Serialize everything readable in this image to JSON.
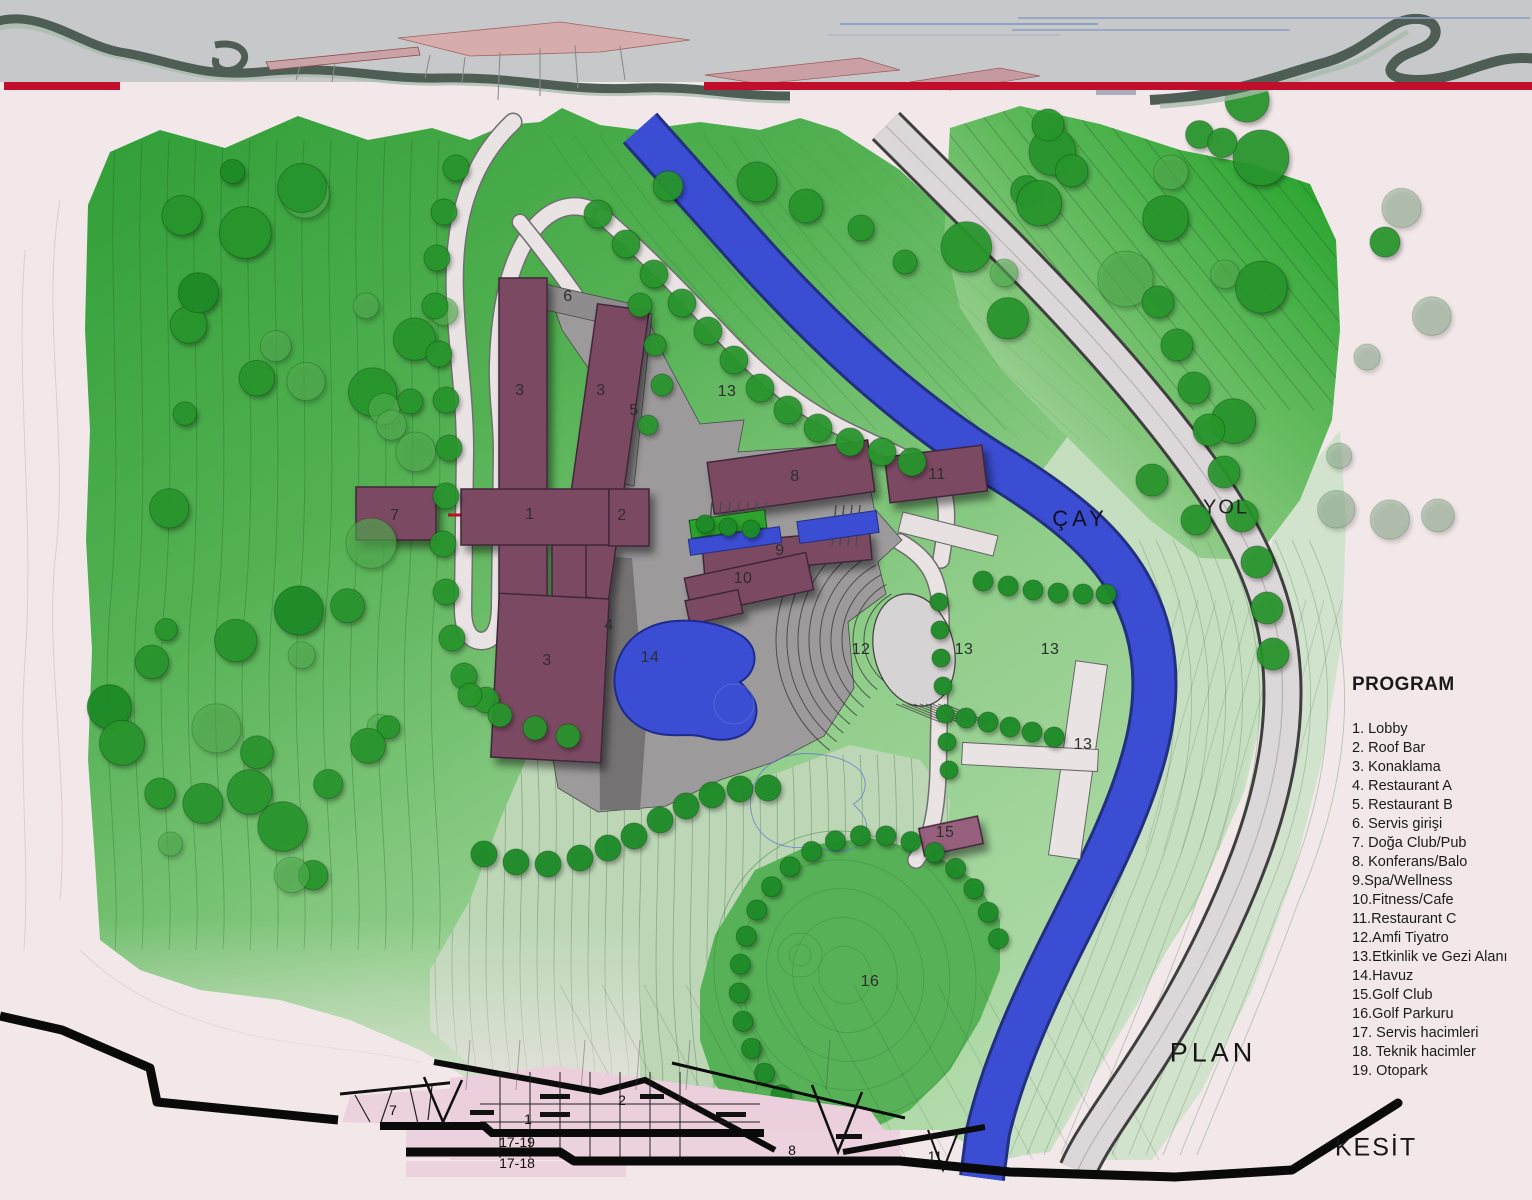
{
  "legend": {
    "title": "PROGRAM",
    "items": [
      "1. Lobby",
      "2. Roof Bar",
      "3. Konaklama",
      "4. Restaurant A",
      "5. Restaurant B",
      "6. Servis girişi",
      "7. Doğa Club/Pub",
      "8. Konferans/Balo",
      "9.Spa/Wellness",
      "10.Fitness/Cafe",
      "11.Restaurant C",
      "12.Amfi Tiyatro",
      "13.Etkinlik ve Gezi Alanı",
      "14.Havuz",
      "15.Golf Club",
      "16.Golf Parkuru",
      "17. Servis hacimleri",
      "18. Teknik hacimler",
      "19. Otopark"
    ]
  },
  "map_labels": {
    "stream": "ÇAY",
    "road": "YOL",
    "plan": "PLAN",
    "section": "KESİT"
  },
  "plan_labels": [
    {
      "text": "6",
      "x": 568,
      "y": 297
    },
    {
      "text": "3",
      "x": 520,
      "y": 391
    },
    {
      "text": "3",
      "x": 601,
      "y": 391
    },
    {
      "text": "5",
      "x": 634,
      "y": 411
    },
    {
      "text": "13",
      "x": 727,
      "y": 392
    },
    {
      "text": "8",
      "x": 795,
      "y": 477
    },
    {
      "text": "11",
      "x": 937,
      "y": 475
    },
    {
      "text": "7",
      "x": 395,
      "y": 516
    },
    {
      "text": "1",
      "x": 530,
      "y": 515
    },
    {
      "text": "2",
      "x": 622,
      "y": 516
    },
    {
      "text": "9",
      "x": 780,
      "y": 551
    },
    {
      "text": "10",
      "x": 743,
      "y": 579
    },
    {
      "text": "4",
      "x": 609,
      "y": 626
    },
    {
      "text": "3",
      "x": 547,
      "y": 661
    },
    {
      "text": "14",
      "x": 650,
      "y": 658
    },
    {
      "text": "12",
      "x": 861,
      "y": 650
    },
    {
      "text": "13",
      "x": 964,
      "y": 650
    },
    {
      "text": "13",
      "x": 1050,
      "y": 650
    },
    {
      "text": "13",
      "x": 1083,
      "y": 745
    },
    {
      "text": "15",
      "x": 945,
      "y": 833
    },
    {
      "text": "16",
      "x": 870,
      "y": 982
    }
  ],
  "section_labels": [
    {
      "text": "7",
      "x": 393,
      "y": 1110
    },
    {
      "text": "1",
      "x": 528,
      "y": 1119
    },
    {
      "text": "2",
      "x": 622,
      "y": 1100
    },
    {
      "text": "17-19",
      "x": 517,
      "y": 1142
    },
    {
      "text": "17-18",
      "x": 517,
      "y": 1163
    },
    {
      "text": "8",
      "x": 792,
      "y": 1150
    },
    {
      "text": "11",
      "x": 935,
      "y": 1156
    }
  ],
  "colors": {
    "accent_red": "#c00e2c",
    "building_plum": "#7c4a63",
    "building_light": "#96607c",
    "water_blue": "#3b4dd2",
    "forest_green": "#2f9e36",
    "pale_mint": "#cfe3cc",
    "plaza_gray": "#9c9a9b",
    "path_gray": "#e9e3e3",
    "background_pink": "#f2e8e9",
    "banner_gray": "#c7c8c9"
  }
}
